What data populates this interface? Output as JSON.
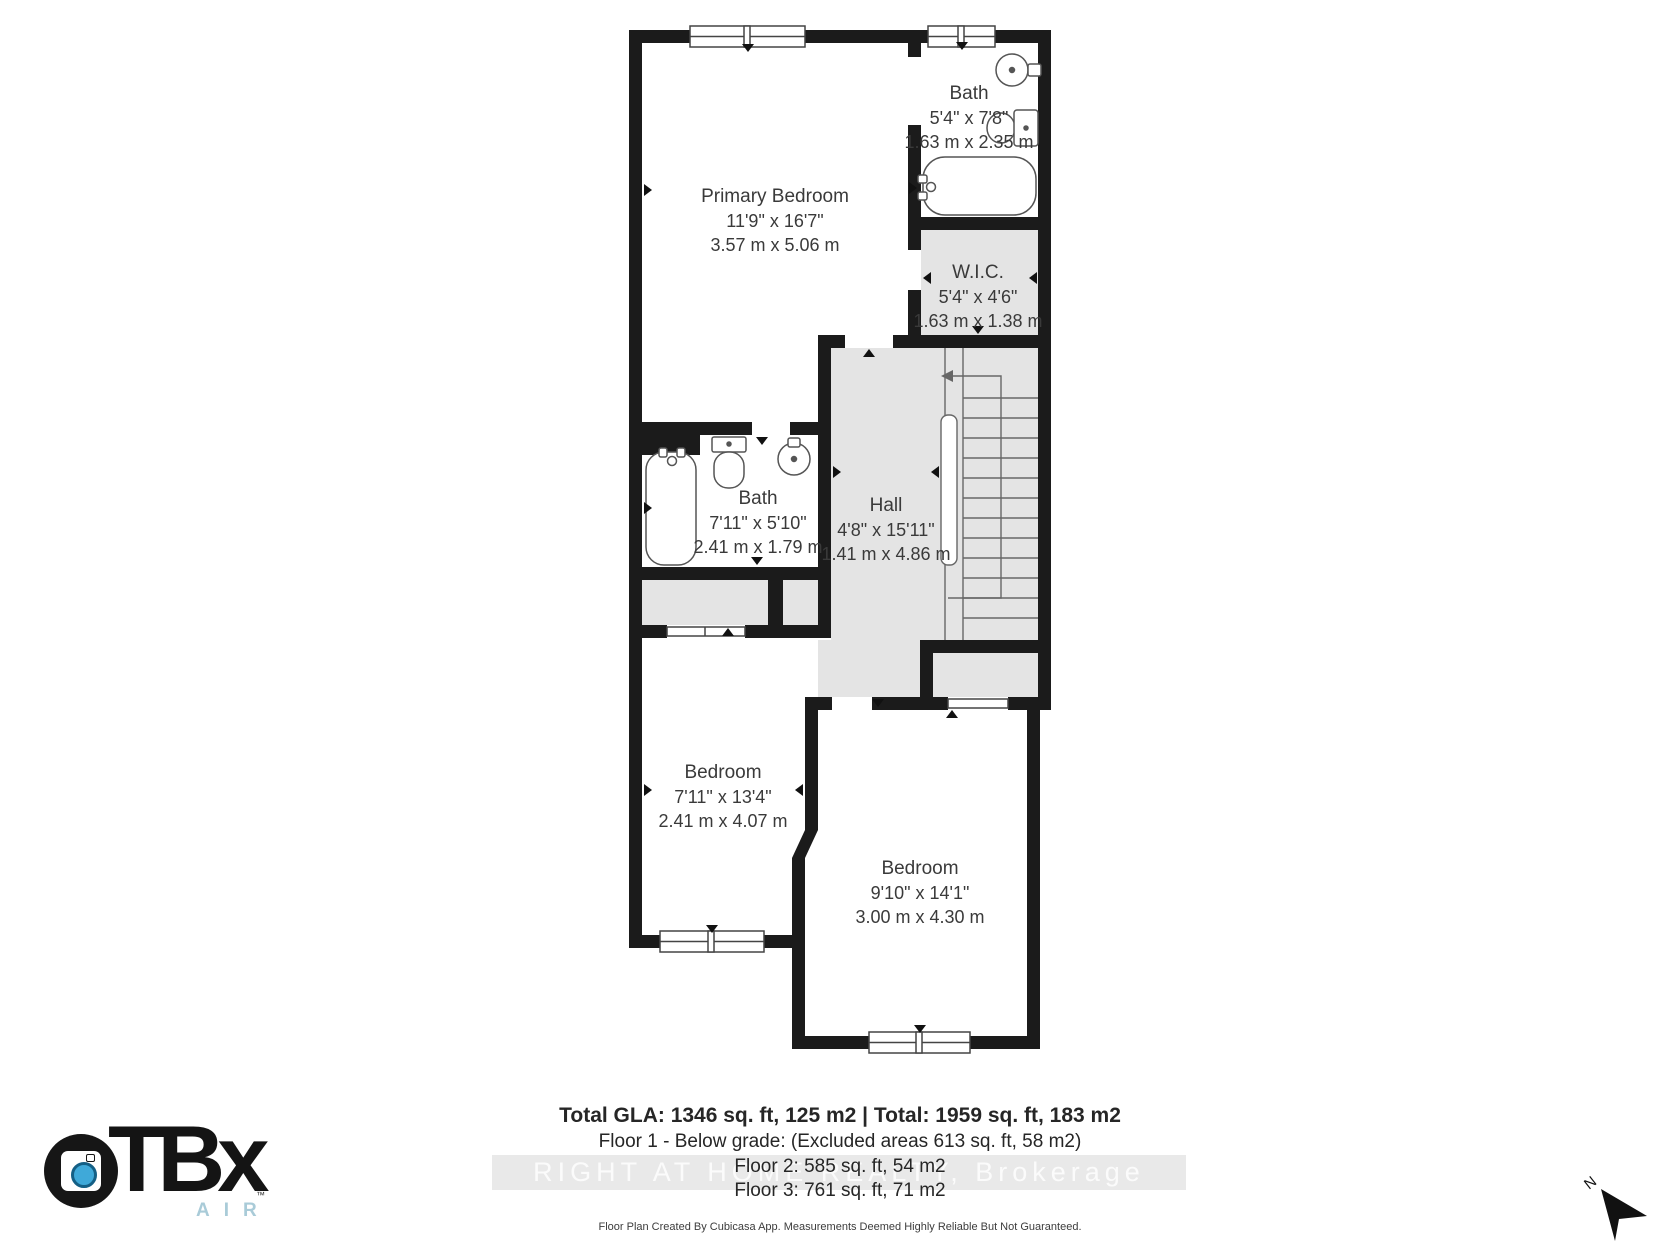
{
  "plan": {
    "rooms": [
      {
        "id": "primary-bedroom",
        "name": "Primary Bedroom",
        "imperial": "11'9\" x 16'7\"",
        "metric": "3.57 m x 5.06 m"
      },
      {
        "id": "bath-upper",
        "name": "Bath",
        "imperial": "5'4\" x 7'8\"",
        "metric": "1.63 m x 2.35 m"
      },
      {
        "id": "wic",
        "name": "W.I.C.",
        "imperial": "5'4\" x 4'6\"",
        "metric": "1.63 m x 1.38 m"
      },
      {
        "id": "hall",
        "name": "Hall",
        "imperial": "4'8\" x 15'11\"",
        "metric": "1.41 m x 4.86 m"
      },
      {
        "id": "bath-main",
        "name": "Bath",
        "imperial": "7'11\" x 5'10\"",
        "metric": "2.41 m x 1.79 m"
      },
      {
        "id": "bedroom-left",
        "name": "Bedroom",
        "imperial": "7'11\" x 13'4\"",
        "metric": "2.41 m x 4.07 m"
      },
      {
        "id": "bedroom-right",
        "name": "Bedroom",
        "imperial": "9'10\" x 14'1\"",
        "metric": "3.00 m x 4.30 m"
      }
    ]
  },
  "summary": {
    "total_line": "Total GLA: 1346 sq. ft, 125 m2 | Total: 1959 sq. ft, 183 m2",
    "floor1_line": "Floor 1 - Below grade: (Excluded areas 613 sq. ft, 58 m2)",
    "floor2_line": "Floor 2: 585 sq. ft, 54 m2",
    "floor3_line": "Floor 3: 761 sq. ft, 71 m2",
    "disclaimer": "Floor Plan Created By Cubicasa App. Measurements Deemed Highly Reliable But Not Guaranteed."
  },
  "watermark": {
    "text": "RIGHT AT HOME REALTY, Brokerage"
  },
  "logo": {
    "tbx": "TBx",
    "air": "AIR",
    "tm": "™"
  },
  "compass": {
    "label": "N"
  },
  "colors": {
    "wall": "#1b1b1b",
    "area_gray": "#e4e4e4",
    "fixture_stroke": "#555555",
    "stair_line": "#666666",
    "logo_air_blue": "#a9cbd8",
    "lens_blue": "#3fa9d9",
    "watermark_bg": "#e9e9e9",
    "watermark_text": "#fbfbfb"
  }
}
